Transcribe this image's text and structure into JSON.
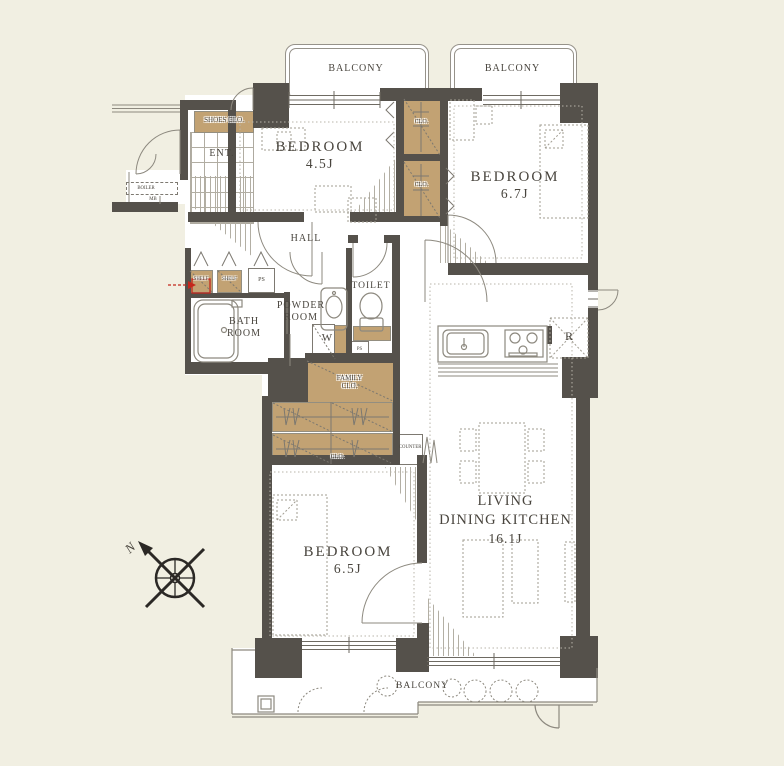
{
  "meta": {
    "kind": "apartment-floor-plan"
  },
  "colors": {
    "background": "#f1efe2",
    "wall": "#55514b",
    "closet_fill": "#c2a273",
    "floor": "#ffffff",
    "line": "#8d897f",
    "text": "#49453e",
    "highlight_red": "#c4281c"
  },
  "labels": {
    "balcony_top_left": "BALCONY",
    "balcony_top_right": "BALCONY",
    "balcony_bottom": "BALCONY",
    "bedroom_a_name": "BEDROOM",
    "bedroom_a_size": "4.5J",
    "bedroom_b_name": "BEDROOM",
    "bedroom_b_size": "6.7J",
    "bedroom_c_name": "BEDROOM",
    "bedroom_c_size": "6.5J",
    "ldk_line1": "LIVING",
    "ldk_line2": "DINING KITCHEN",
    "ldk_size": "16.1J",
    "hall": "HALL",
    "entrance": "ENT.",
    "shoes_closet": "SHOES CLO.",
    "bath_line1": "BATH",
    "bath_line2": "ROOM",
    "powder_line1": "POWDER",
    "powder_line2": "ROOM",
    "toilet": "TOILET",
    "washer": "W",
    "refrigerator": "R",
    "counter": "COUNTER",
    "family_closet_line1": "FAMILY",
    "family_closet_line2": "CLO.",
    "closet_top": "CLO.",
    "closet_middle": "CLO.",
    "closet_bottom": "CLO.",
    "shelf_left": "SHELF",
    "shelf_right": "SHELF",
    "ps_hall": "PS",
    "ps_toilet": "PS",
    "boiler": "BOILER",
    "meter_box": "MB",
    "compass_north": "N"
  }
}
